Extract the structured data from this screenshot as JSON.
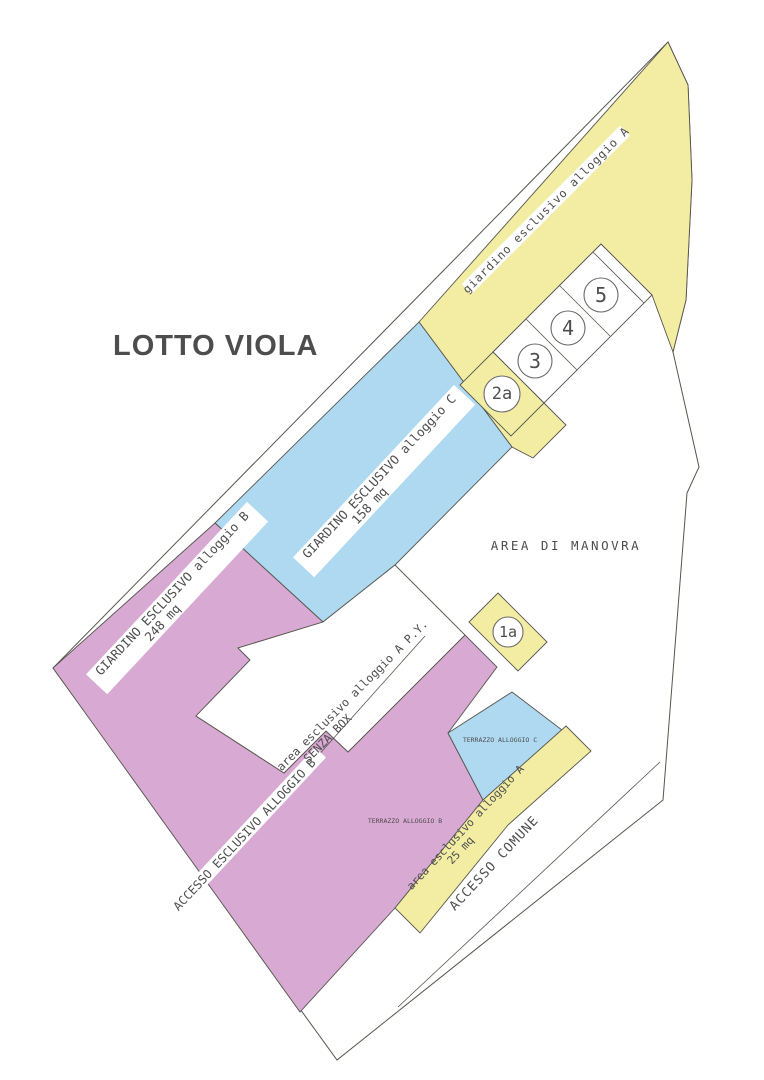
{
  "title": "LOTTO VIOLA",
  "colors": {
    "lot_fill": "#ffffff",
    "outline": "#55554e",
    "text": "#4d4d4d",
    "yellow": "#f3eda4",
    "blue": "#aed9f0",
    "purple": "#d8a9d2",
    "title_color": "#7d2a8c",
    "label_band": "#ffffff"
  },
  "areas": {
    "garden_a": {
      "label": "giardino esclusivo alloggio A"
    },
    "garden_c": {
      "label": "GIARDINO ESCLUSIVO alloggio C",
      "size": "158 mq"
    },
    "garden_b": {
      "label": "GIARDINO ESCLUSIVO alloggio B",
      "size": "248 mq"
    },
    "access_b": {
      "label": "ACCESSO ESCLUSIVO ALLOGGIO B"
    },
    "area_a_py": {
      "label": "area esclusivo alloggio A P.Y.",
      "label2": "SENZA BOX"
    },
    "manovra": {
      "label": "AREA DI MANOVRA"
    },
    "area_a_25": {
      "label": "area esclusivo alloggio A",
      "size": "25 mq"
    },
    "accesso_comune": {
      "label": "ACCESSO COMUNE"
    },
    "terrazzo_b": {
      "label": "TERRAZZO ALLOGGIO B"
    },
    "terrazzo_c": {
      "label": "TERRAZZO ALLOGGIO C"
    }
  },
  "parking": {
    "p1a": "1a",
    "p2a": "2a",
    "p3": "3",
    "p4": "4",
    "p5": "5"
  }
}
